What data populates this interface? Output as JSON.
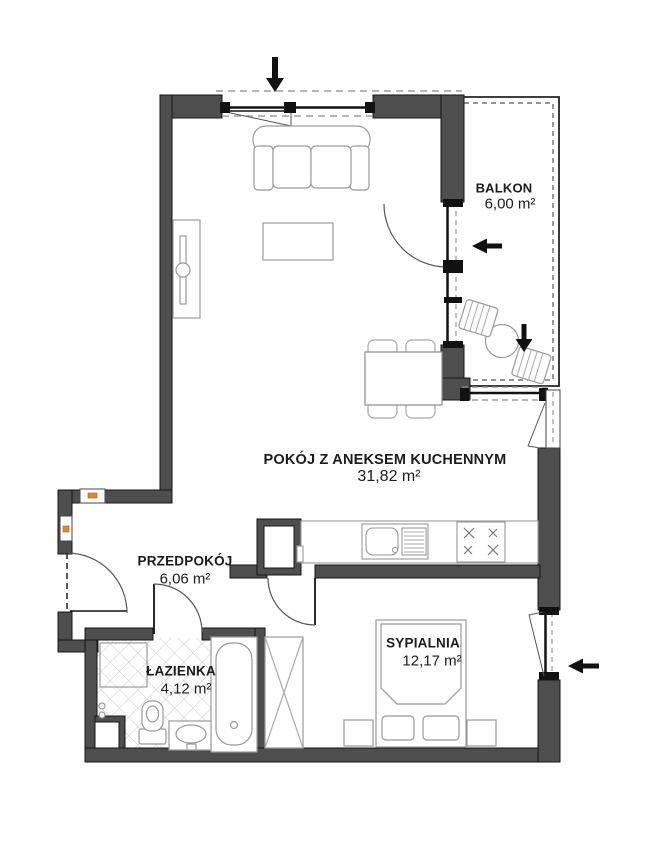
{
  "rooms": [
    {
      "name": "POKÓJ Z ANEKSEM KUCHENNYM",
      "area": "31,82 m²"
    },
    {
      "name": "BALKON",
      "area": "6,00 m²"
    },
    {
      "name": "PRZEDPOKÓJ",
      "area": "6,06 m²"
    },
    {
      "name": "ŁAZIENKA",
      "area": "4,12 m²"
    },
    {
      "name": "SYPIALNIA",
      "area": "12,17 m²"
    }
  ],
  "arrows": [
    {
      "location": "living-room-top-window",
      "direction": "down"
    },
    {
      "location": "balcony-door",
      "direction": "left"
    },
    {
      "location": "balcony-inner",
      "direction": "down"
    },
    {
      "location": "bedroom-window",
      "direction": "left"
    }
  ],
  "colors": {
    "wall": "#4e4e4e",
    "line": "#111111",
    "furniture": "#999999",
    "tile": "#c9c9c9",
    "accent_orange": "#e2862f",
    "background": "#ffffff"
  }
}
